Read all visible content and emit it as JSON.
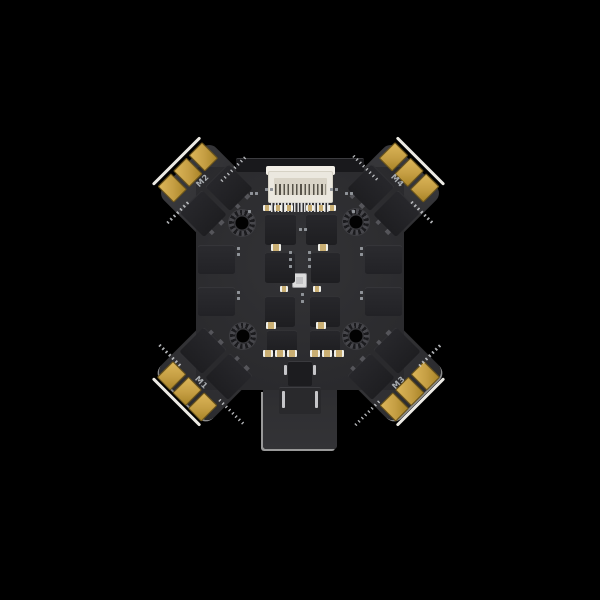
{
  "scene": {
    "subject": "4-in-1 drone ESC circuit board, top-down product photo on black background",
    "background_color": "#000000"
  },
  "board": {
    "motor_pads": [
      {
        "label": "M2",
        "position": "top-left"
      },
      {
        "label": "M4",
        "position": "top-right"
      },
      {
        "label": "M1",
        "position": "bottom-left"
      },
      {
        "label": "M3",
        "position": "bottom-right"
      }
    ],
    "connectors": {
      "top": "white FFC ribbon connector",
      "bottom": "power tab with capacitor and socket"
    },
    "colors": {
      "pcb": "#2e2e31",
      "chips": "#212124",
      "solder_pads_gold": "#c59e43",
      "connector_white": "#ebe8df",
      "silkscreen_label": "#a8acb0"
    }
  }
}
